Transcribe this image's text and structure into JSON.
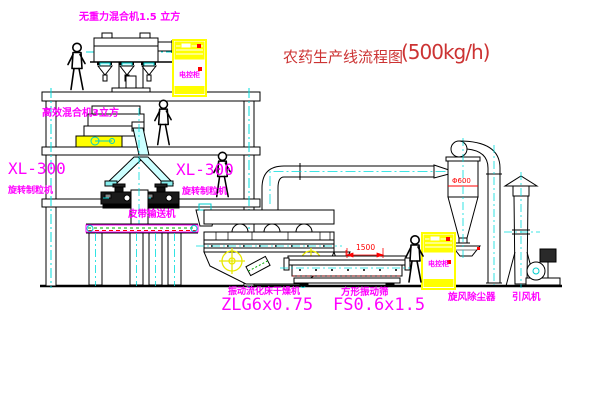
{
  "title": {
    "main": "农药生产线流程图",
    "capacity": "(500kg/h)"
  },
  "equipment_labels": {
    "gravity_free_mixer": "无重力混合机1.5 立方",
    "high_efficiency_mixer": "高效混合机3立方",
    "granulator_left_model": "XL-300",
    "granulator_left_name": "旋转制粒机",
    "granulator_mid_model": "XL-300",
    "granulator_mid_name": "旋转制粒机",
    "belt_conveyor": "皮带输送机",
    "fluid_bed_dryer_name": "振动流化床干燥机",
    "fluid_bed_dryer_model": "ZLG6x0.75",
    "vibrating_sieve_name": "方形振动筛",
    "vibrating_sieve_model": "FS0.6x1.5",
    "cyclone_dust_collector": "旋风除尘器",
    "induced_draft_fan": "引风机"
  },
  "control_cabinets": {
    "upper": "电控柜",
    "lower": "电控柜"
  },
  "dimensions": {
    "cyclone_diameter": "Φ600",
    "sieve_length": "1500"
  },
  "colors": {
    "label_magenta": "#ff00ff",
    "title_red": "#cc3333",
    "dimension_red": "#ff0000",
    "centerline_cyan": "#00dddd",
    "cabinet_yellow": "#ffff00",
    "conveyor_green": "#00aa00"
  }
}
